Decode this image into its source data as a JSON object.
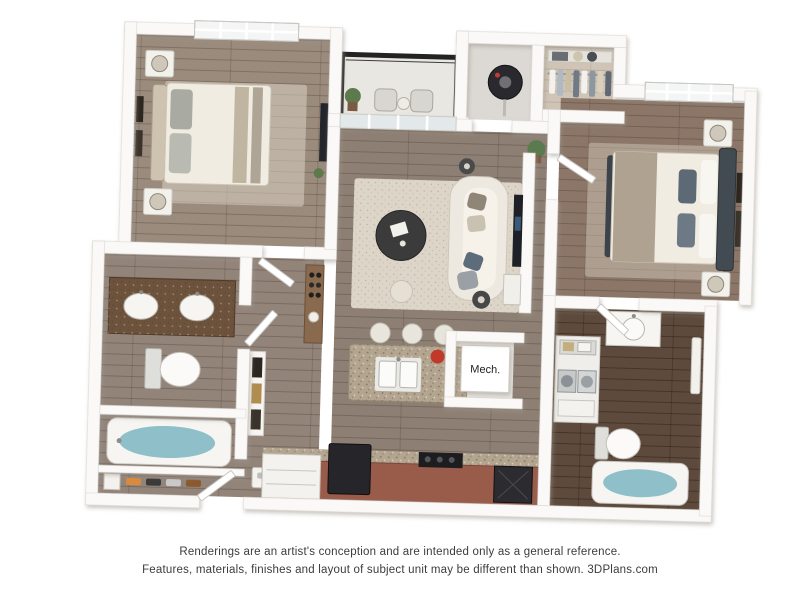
{
  "floorplan": {
    "mech_label": "Mech.",
    "rooms": [
      "bedroom-1",
      "bathroom-1",
      "shoe-closet",
      "hallway",
      "living-room",
      "balcony",
      "utility-closet",
      "walk-in-closet",
      "bedroom-2",
      "bathroom-2",
      "laundry-nook",
      "mechanical-closet",
      "kitchen"
    ],
    "palette": {
      "wall": "#faf9f7",
      "wood_main": "#8d7f73",
      "wood_light": "#9a8b7d",
      "wood_dark": "#5d4a3c",
      "rug": "#ddd5c7",
      "cabinet_brown": "#995c4b",
      "granite": "#b3a58f",
      "vanity_brown": "#6d523c",
      "water_blue": "#8fc0c9",
      "railing_black": "#232323",
      "appliance_dark": "#26262a",
      "headboard_slate": "#424a52",
      "accent_red": "#c0392b"
    }
  },
  "footer": {
    "line1": "Renderings are an artist's conception and are intended only as a general reference.",
    "line2": "Features, materials, finishes and layout of subject unit may be different than shown. 3DPlans.com"
  }
}
